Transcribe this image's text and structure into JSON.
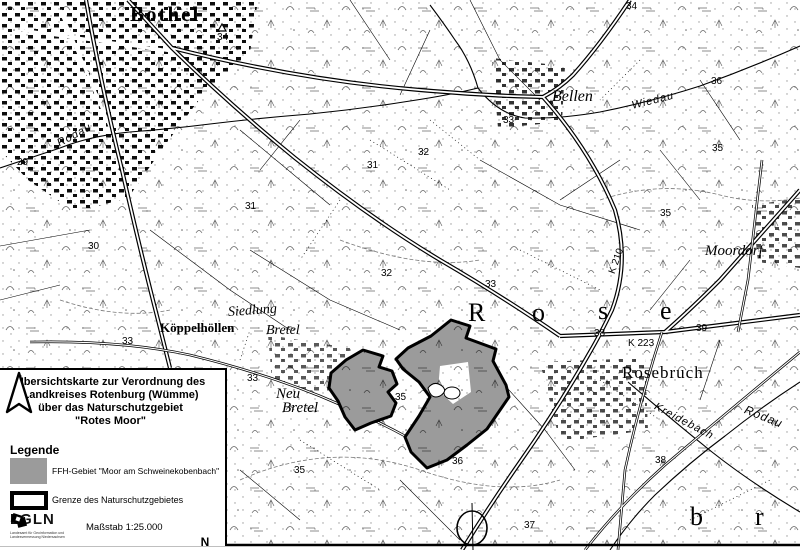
{
  "panel": {
    "title_lines": [
      "Übersichtskarte zur Verordnung des",
      "Landkreises Rotenburg (Wümme)",
      "über das Naturschutzgebiet",
      "\"Rotes Moor\""
    ],
    "legend": {
      "heading": "Legende",
      "items": [
        {
          "label": "FFH-Gebiet \"Moor am Schweinekobenbach\"",
          "swatch": "gray-fill",
          "color": "#9b9b9b"
        },
        {
          "label": "Grenze des Naturschutzgebietes",
          "swatch": "black-outline",
          "color": "#000000"
        }
      ]
    },
    "logo": {
      "text": "LGLN",
      "subtext": "Landesamt für Geoinformation und Landesvermessung Niedersachsen"
    },
    "scale_label": "Maßstab 1:25.000",
    "north_label": "N"
  },
  "map": {
    "labels": {
      "bothel": "Bothel",
      "bellen": "Bellen",
      "wiedau": "Wiedau",
      "moordorf": "Moordorf",
      "rosebruch": "Rosebruch",
      "koeppelhoellen": "Köppelhöllen",
      "siedlung": "Siedlung",
      "bretel_a": "Bretel",
      "neu": "Neu",
      "bretel_b": "Bretel",
      "rodau_a": "Rodau",
      "rodau_b": "Rodau",
      "kreidebach": "Kreidebach",
      "rose_r": "R",
      "rose_o": "o",
      "rose_s": "s",
      "rose_e": "e",
      "letter_b": "b",
      "letter_r": "r",
      "k210": "K 210",
      "k223": "K 223",
      "n29": "29",
      "n30": "30",
      "n31a": "31",
      "n31b": "31",
      "n32a": "32",
      "n32b": "32",
      "n33a": "33",
      "n33b": "33",
      "n33c": "33",
      "n33d": "33",
      "n34a": "34",
      "n34b": "34",
      "n35a": "35",
      "n35b": "35",
      "n35c": "35",
      "n35d": "35",
      "n36a": "36",
      "n36b": "36",
      "n37": "37",
      "n38a": "38",
      "n38b": "38",
      "n39": "39"
    },
    "colors": {
      "ffh_gray": "#9b9b9b",
      "line_black": "#000000"
    }
  }
}
